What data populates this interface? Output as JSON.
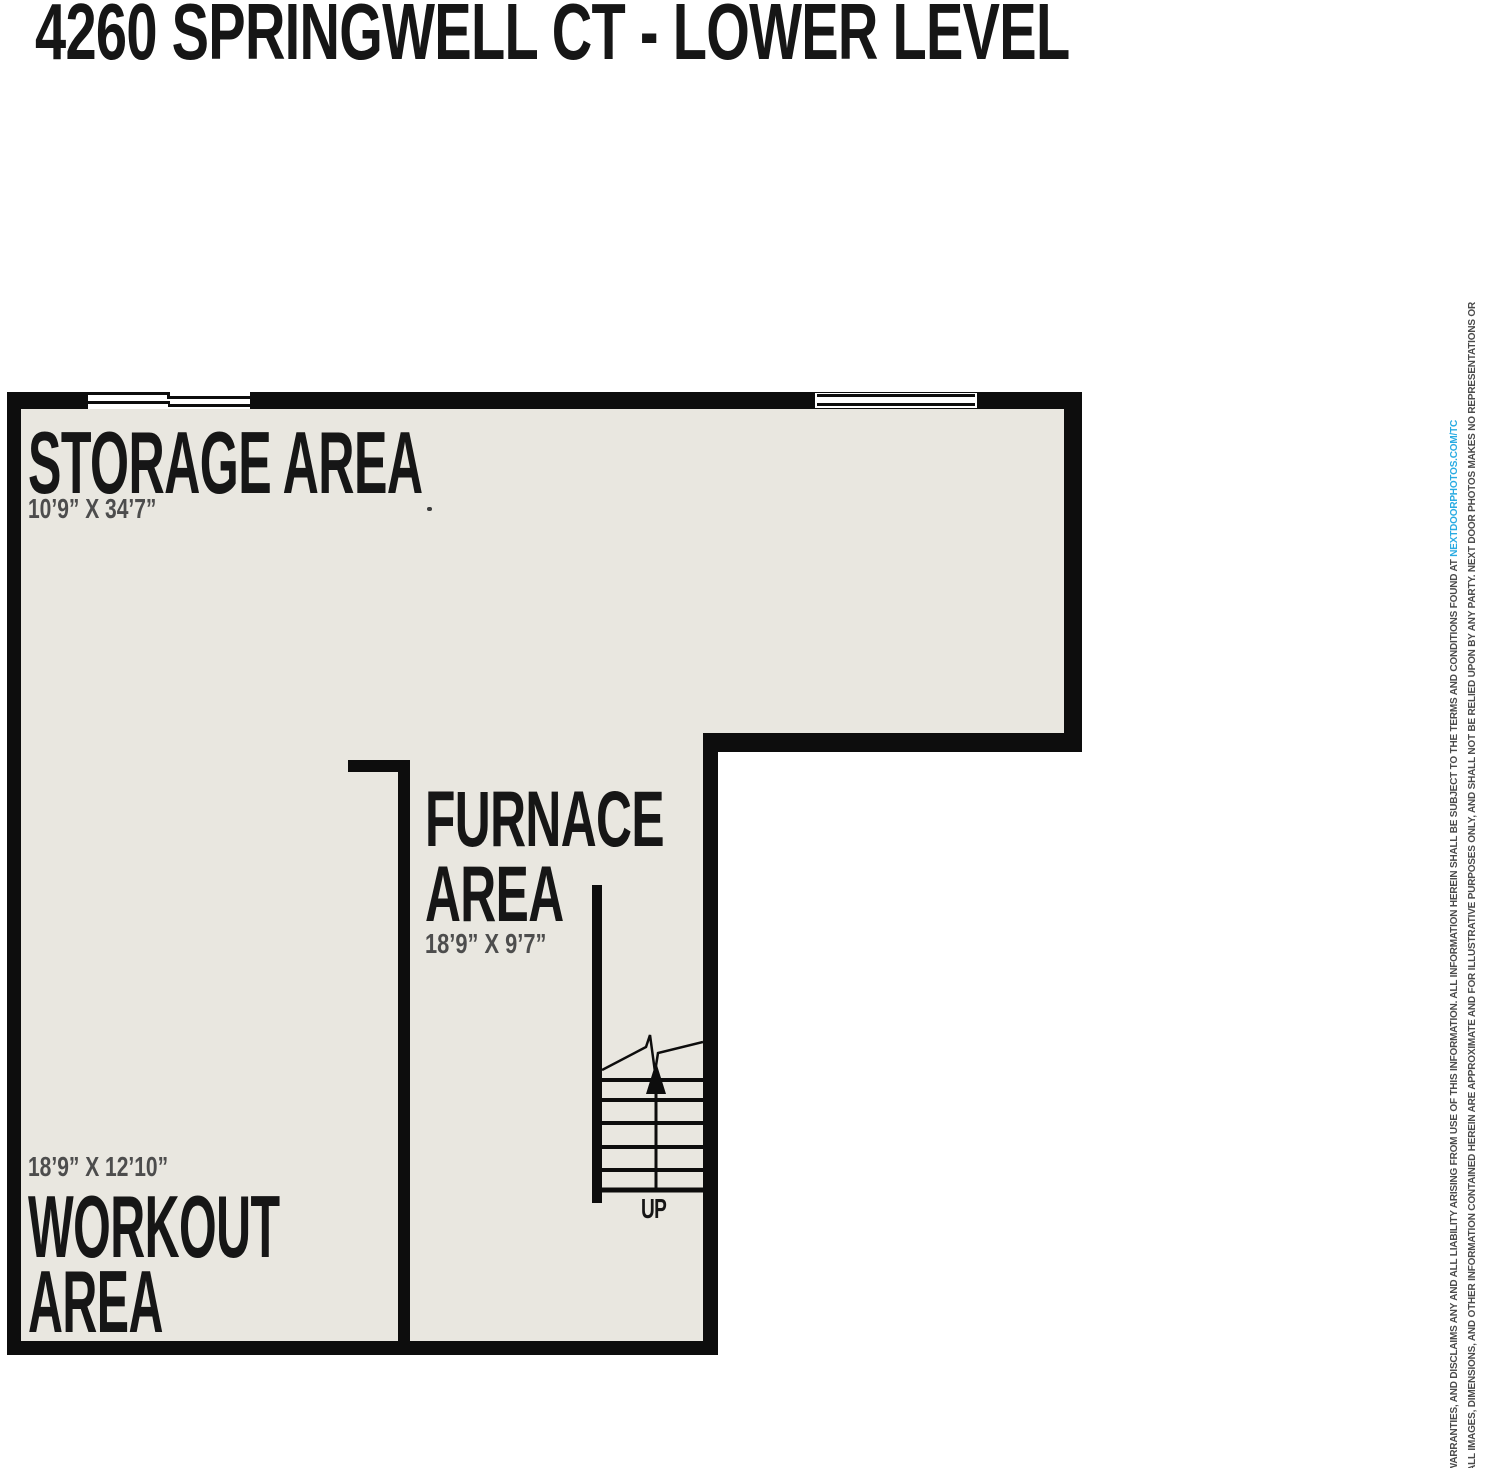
{
  "title": "4260 SPRINGWELL CT - LOWER LEVEL",
  "rooms": {
    "storage": {
      "name": "STORAGE AREA",
      "dims": "10’9” X 34’7”"
    },
    "furnace": {
      "line1": "FURNACE",
      "line2": "AREA",
      "dims": "18’9” X 9’7”"
    },
    "workout": {
      "line1": "WORKOUT",
      "line2": "AREA",
      "dims": "18’9” X 12’10”"
    }
  },
  "stairs": {
    "label": "UP"
  },
  "disclaimer": {
    "line1": "ALL IMAGES, DIMENSIONS, AND OTHER INFORMATION CONTAINED HEREIN ARE APPROXIMATE AND FOR ILLUSTRATIVE PURPOSES ONLY, AND SHALL NOT BE RELIED UPON BY ANY PARTY. NEXT DOOR PHOTOS MAKES NO REPRESENTATIONS OR",
    "line2_prefix": "WARRANTIES, AND DISCLAIMS ANY AND ALL LIABILITY ARISING FROM USE OF THIS INFORMATION. ALL INFORMATION HEREIN SHALL BE SUBJECT TO THE TERMS AND CONDITIONS FOUND AT ",
    "line2_link": "NEXTDOORPHOTOS.COM/TC"
  },
  "colors": {
    "wall": "#0d0d0d",
    "floor": "#e9e7e0",
    "ink": "#161616",
    "dim": "#4d4d4d",
    "accent": "#29abe2",
    "page": "#ffffff"
  }
}
